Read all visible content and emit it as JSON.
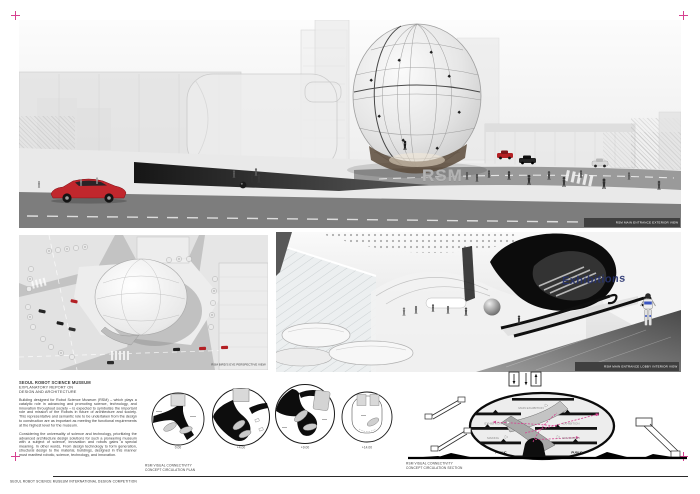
{
  "accent": {
    "pink": "#d6408f",
    "navy": "#26326e",
    "car_red": "#c1272d"
  },
  "hero": {
    "sign_text": "RSM",
    "caption": "RSM MAIN ENTRANCE EXTERIOR VIEW"
  },
  "aerial": {
    "caption": "RSM BIRD'S EYE PERSPECTIVE VIEW"
  },
  "interior": {
    "wall_text": "Exhibitions",
    "caption": "RSM MAIN ENTRANCE LOBBY INTERIOR VIEW"
  },
  "report": {
    "title": "SEOUL ROBOT SCIENCE MUSEUM",
    "subtitle_line1": "EXPLANATORY REPORT ON",
    "subtitle_line2": "DESIGN AND ARCHITECTURE",
    "paragraph1": "Building designed for Robot Science Museum (RSM) – which plays a catalytic role in advancing and promoting science, technology, and innovation throughout society – is expected to symbolize the important role and mission of the Robots in future of architecture and society. This representative and semantic role to be undertaken from the design to construction are as important as meeting the functional requirements at the highest level for the museum.",
    "paragraph2": "Considering the universality of science and technology, prioritizing the advanced architecture design solutions for such a pioneering museum with a subject of science, innovation and robots gains a special meaning. In other words, From design technology to form generation, structural design to the material, buildings, designed in this manner must manifest robotic, science, technology, and innovation."
  },
  "plans": {
    "caption_line1": "RSM VISUAL CONNECTIVITY",
    "caption_line2": "CONCEPT CIRCULATION PLAN",
    "levels": [
      "0.00",
      "+4.00",
      "+9.00",
      "+14.00"
    ]
  },
  "section": {
    "caption_line1": "RSM VISUAL CONNECTIVITY",
    "caption_line2": "CONCEPT CIRCULATION SECTION",
    "labels": {
      "top": "MAIN EXHIBITION",
      "mid_left": "EXHIBITION",
      "mid_right": "EXHIBITION",
      "low_left": "MAKING",
      "low_right": "EDUCATION",
      "public_left": "PUBLIC",
      "public_right": "PUBLIC"
    }
  },
  "footer": {
    "text": "SEOUL ROBOT SCIENCE MUSEUM INTERNATIONAL DESIGN COMPETITION"
  }
}
